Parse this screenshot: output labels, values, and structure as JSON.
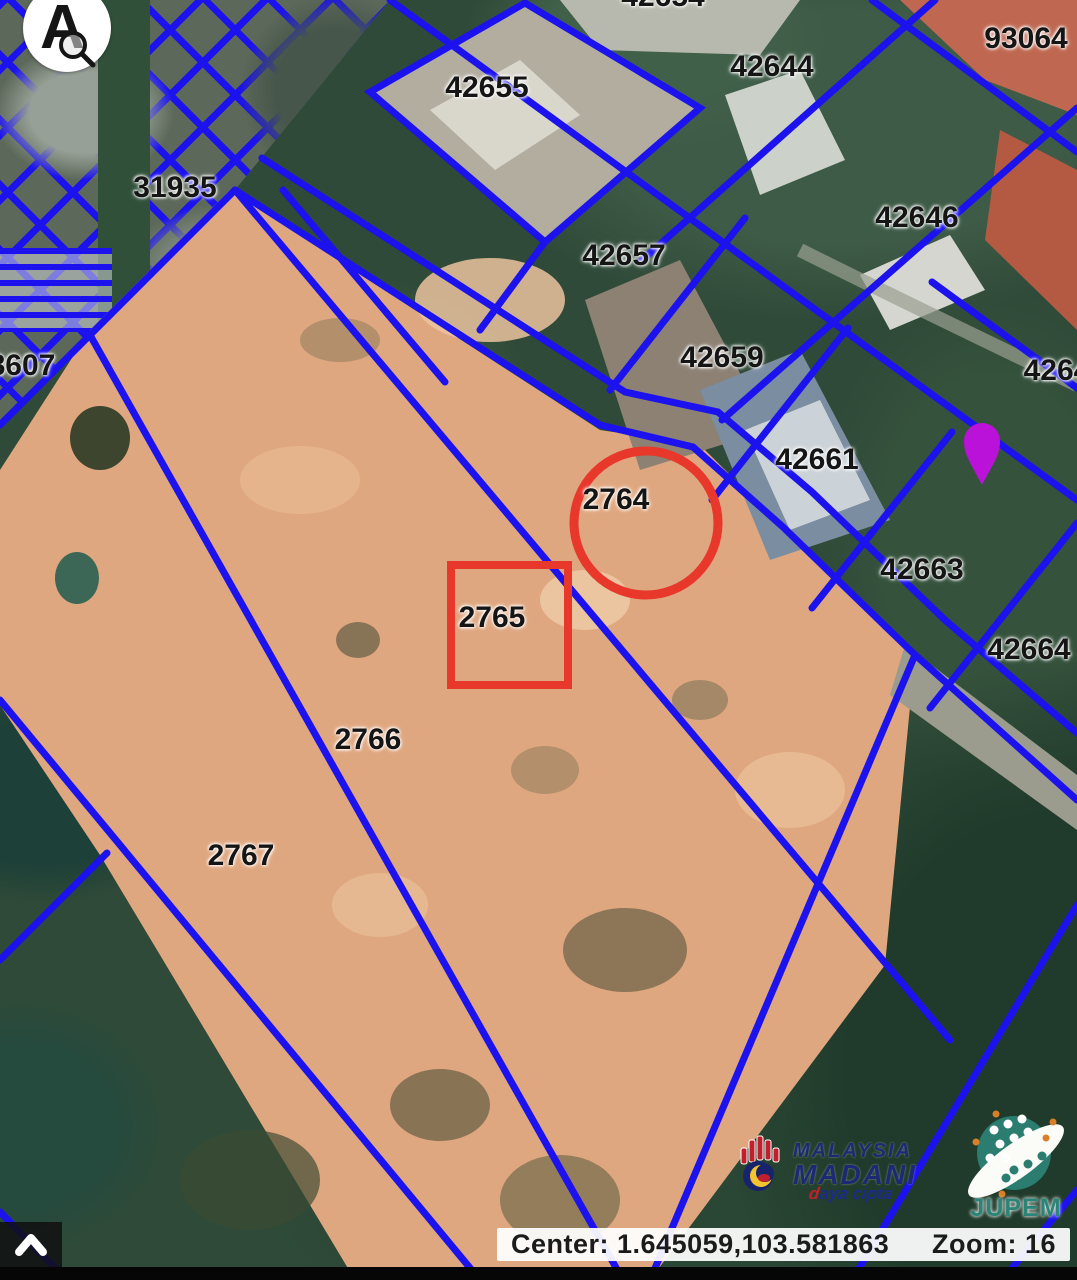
{
  "map": {
    "type": "satellite-cadastral",
    "boundary_color": "#1b12ee",
    "highlight_color": "#e8382c",
    "marker_color": "#bb12d9",
    "parcel_labels": [
      {
        "text": "42654",
        "x": 663,
        "y": -3
      },
      {
        "text": "42655",
        "x": 487,
        "y": 88
      },
      {
        "text": "42644",
        "x": 772,
        "y": 67
      },
      {
        "text": "93064",
        "x": 1026,
        "y": 39
      },
      {
        "text": "31935",
        "x": 175,
        "y": 188
      },
      {
        "text": "42646",
        "x": 917,
        "y": 218
      },
      {
        "text": "42657",
        "x": 624,
        "y": 256
      },
      {
        "text": "42659",
        "x": 722,
        "y": 358
      },
      {
        "text": "8607",
        "x": 22,
        "y": 366
      },
      {
        "text": "4264",
        "x": 1057,
        "y": 371
      },
      {
        "text": "42661",
        "x": 817,
        "y": 460
      },
      {
        "text": "42663",
        "x": 922,
        "y": 570
      },
      {
        "text": "42664",
        "x": 1029,
        "y": 650
      },
      {
        "text": "2764",
        "x": 616,
        "y": 500
      },
      {
        "text": "2765",
        "x": 492,
        "y": 618
      },
      {
        "text": "2766",
        "x": 368,
        "y": 740
      },
      {
        "text": "2767",
        "x": 241,
        "y": 856
      }
    ],
    "annotations": [
      {
        "shape": "circle",
        "lot": "2764",
        "color": "#e8382c"
      },
      {
        "shape": "rectangle",
        "lot": "2765",
        "color": "#e8382c"
      }
    ],
    "marker": {
      "name": "map-pin",
      "color": "#bb12d9"
    }
  },
  "status_bar": {
    "center_text": "Center: 1.645059,103.581863",
    "zoom_text": "Zoom: 16"
  },
  "controls": {
    "collapse_icon": "chevron-up"
  },
  "logos": {
    "lens": {
      "letter": "A",
      "icon": "magnifier"
    },
    "madani": {
      "line1": "MALAYSIA",
      "line2": "MADANI",
      "script": "daya cipta"
    },
    "jupem": {
      "text": "JUPEM"
    }
  }
}
